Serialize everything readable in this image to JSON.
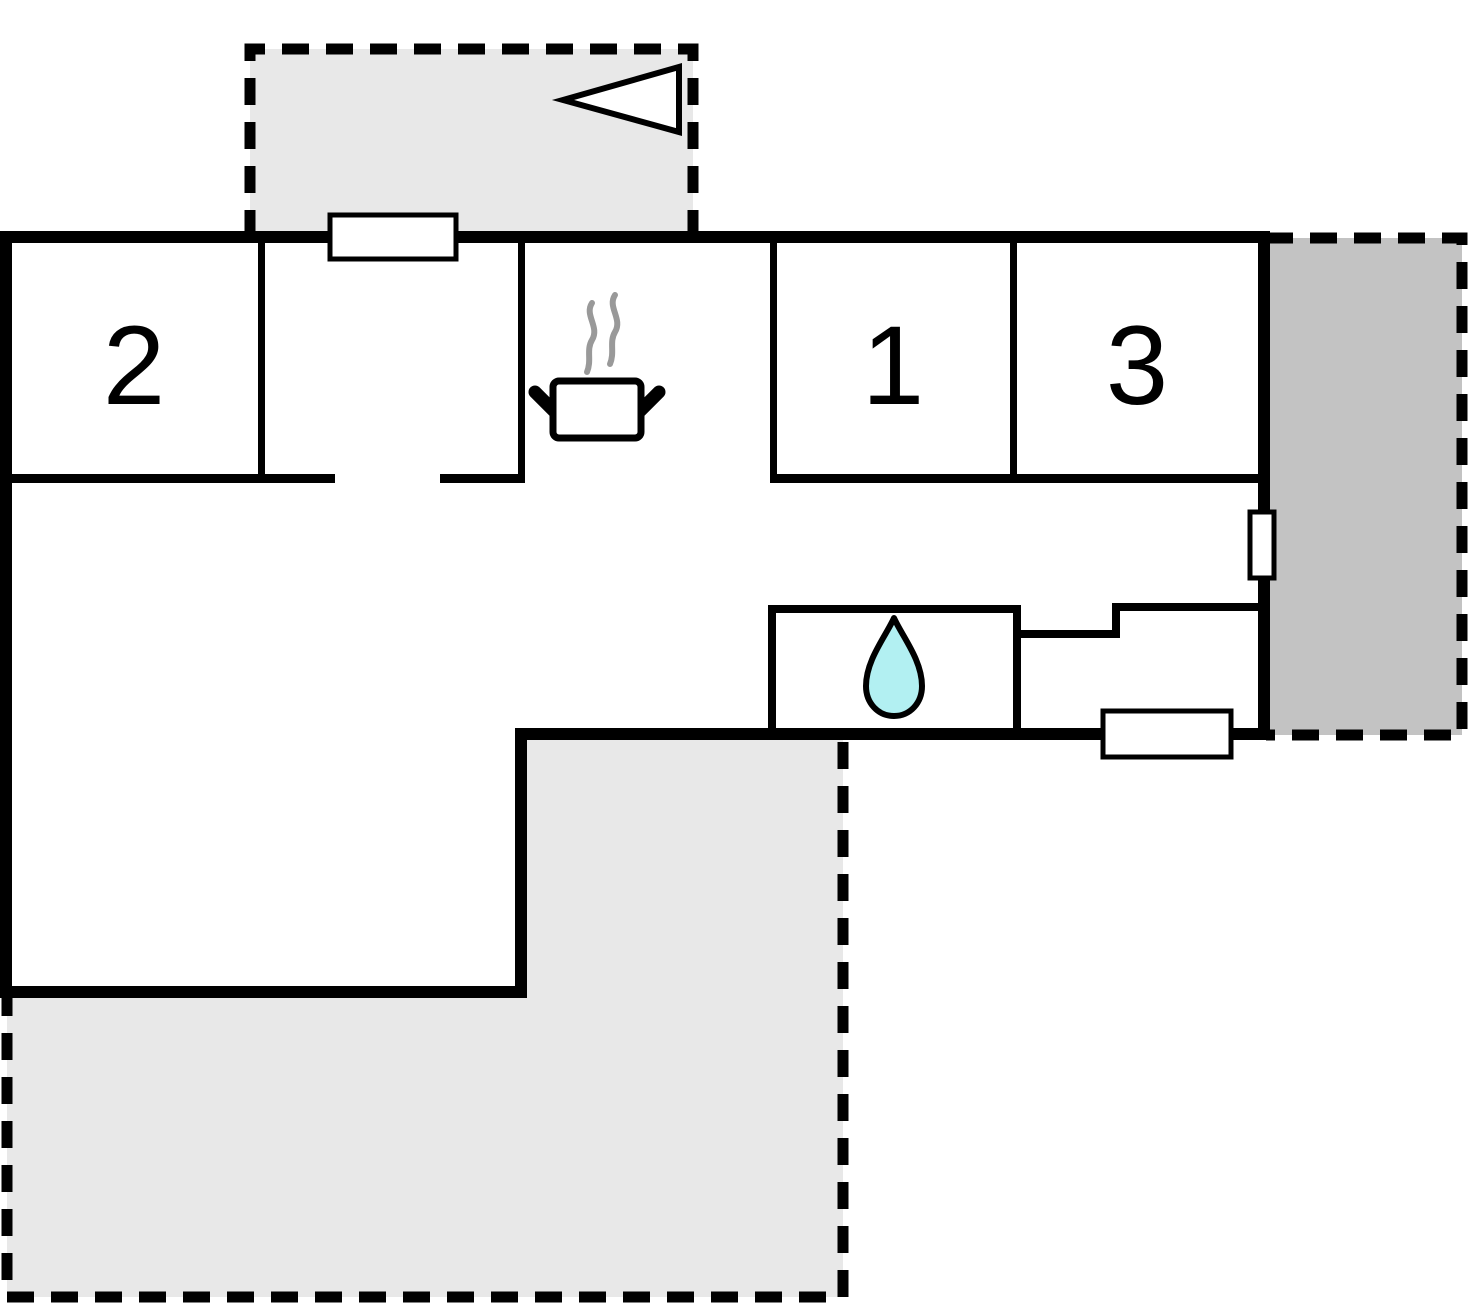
{
  "rooms": [
    {
      "id": "room-2",
      "label": "2"
    },
    {
      "id": "room-1",
      "label": "1"
    },
    {
      "id": "room-3",
      "label": "3"
    }
  ],
  "icons": {
    "kitchen": "steaming-pot-icon",
    "bathroom": "water-drop-icon",
    "top_terrace": "left-pointing-triangle-icon"
  },
  "colors": {
    "wall": "#000000",
    "room_fill": "#ffffff",
    "terrace_light": "#e8e8e8",
    "terrace_dark": "#c3c3c3",
    "water_drop": "#b2f0f2",
    "steam": "#999999"
  }
}
